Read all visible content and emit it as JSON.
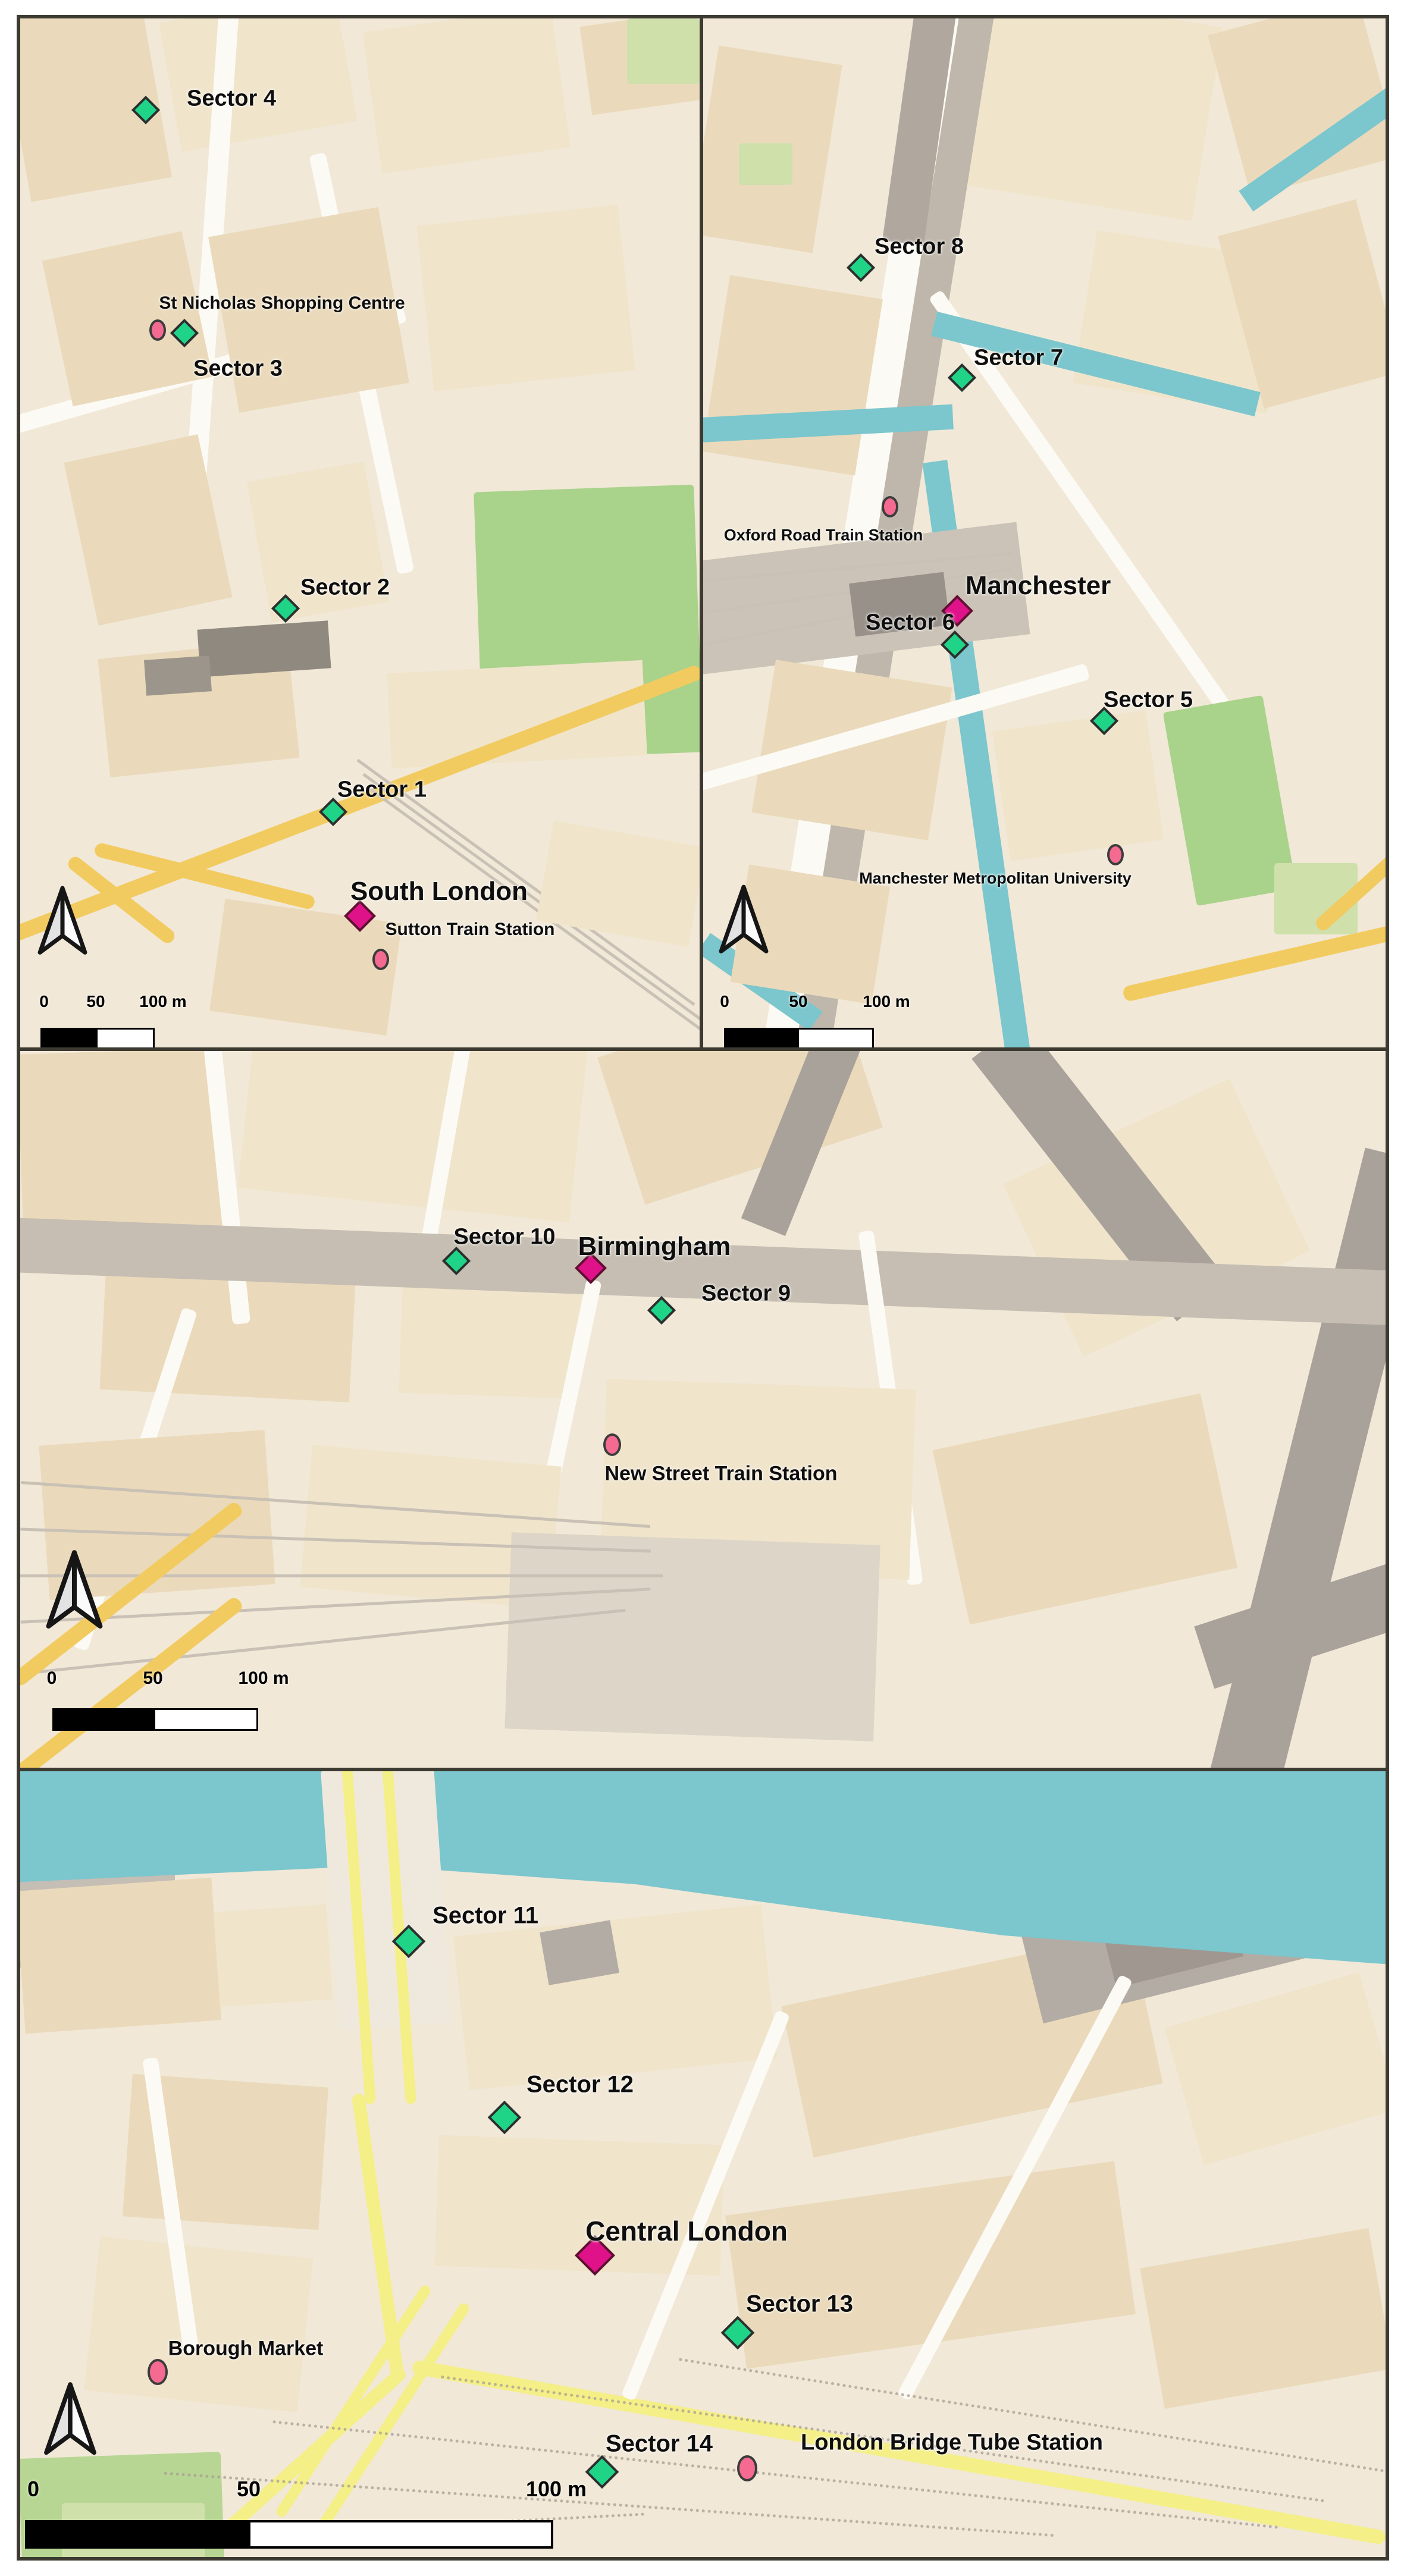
{
  "map_colors": {
    "background": "#f1e8d7",
    "building": "#eadabb",
    "water": "#7cc6cd",
    "park": "#a9d28b",
    "road_yellow": "#f2cb60",
    "road_yellow_pale": "#f4ef86",
    "road_gray": "#a9a29a",
    "panel_border": "#3c3a31"
  },
  "symbology": {
    "sector_site": {
      "shape": "diamond",
      "color": "#1fd487"
    },
    "city_centre": {
      "shape": "diamond",
      "color": "#e01289"
    },
    "landmark": {
      "shape": "ellipse",
      "color": "#f56a90"
    }
  },
  "panels": [
    {
      "id": "south-london-sutton",
      "markers": [
        {
          "type": "sector",
          "label": "Sector 4"
        },
        {
          "type": "landmark",
          "label": "St Nicholas Shopping Centre"
        },
        {
          "type": "sector",
          "label": "Sector 3"
        },
        {
          "type": "sector",
          "label": "Sector 2"
        },
        {
          "type": "sector",
          "label": "Sector 1"
        },
        {
          "type": "city",
          "label": "South London"
        },
        {
          "type": "landmark",
          "label": "Sutton Train Station"
        }
      ],
      "scale_bar": {
        "start": "0",
        "mid": "50",
        "end": "100 m"
      }
    },
    {
      "id": "manchester",
      "markers": [
        {
          "type": "sector",
          "label": "Sector 8"
        },
        {
          "type": "sector",
          "label": "Sector 7"
        },
        {
          "type": "landmark",
          "label": "Oxford Road Train Station"
        },
        {
          "type": "city",
          "label": "Manchester"
        },
        {
          "type": "sector",
          "label": "Sector 6"
        },
        {
          "type": "sector",
          "label": "Sector 5"
        },
        {
          "type": "landmark",
          "label": "Manchester Metropolitan University"
        }
      ],
      "scale_bar": {
        "start": "0",
        "mid": "50",
        "end": "100 m"
      }
    },
    {
      "id": "birmingham",
      "markers": [
        {
          "type": "sector",
          "label": "Sector 10"
        },
        {
          "type": "city",
          "label": "Birmingham"
        },
        {
          "type": "sector",
          "label": "Sector 9"
        },
        {
          "type": "landmark",
          "label": "New Street Train Station"
        }
      ],
      "scale_bar": {
        "start": "0",
        "mid": "50",
        "end": "100 m"
      }
    },
    {
      "id": "central-london",
      "markers": [
        {
          "type": "sector",
          "label": "Sector 11"
        },
        {
          "type": "sector",
          "label": "Sector 12"
        },
        {
          "type": "city",
          "label": "Central London"
        },
        {
          "type": "sector",
          "label": "Sector 13"
        },
        {
          "type": "landmark",
          "label": "Borough Market"
        },
        {
          "type": "sector",
          "label": "Sector 14"
        },
        {
          "type": "landmark",
          "label": "London Bridge Tube Station"
        }
      ],
      "scale_bar": {
        "start": "0",
        "mid": "50",
        "end": "100 m"
      }
    }
  ]
}
